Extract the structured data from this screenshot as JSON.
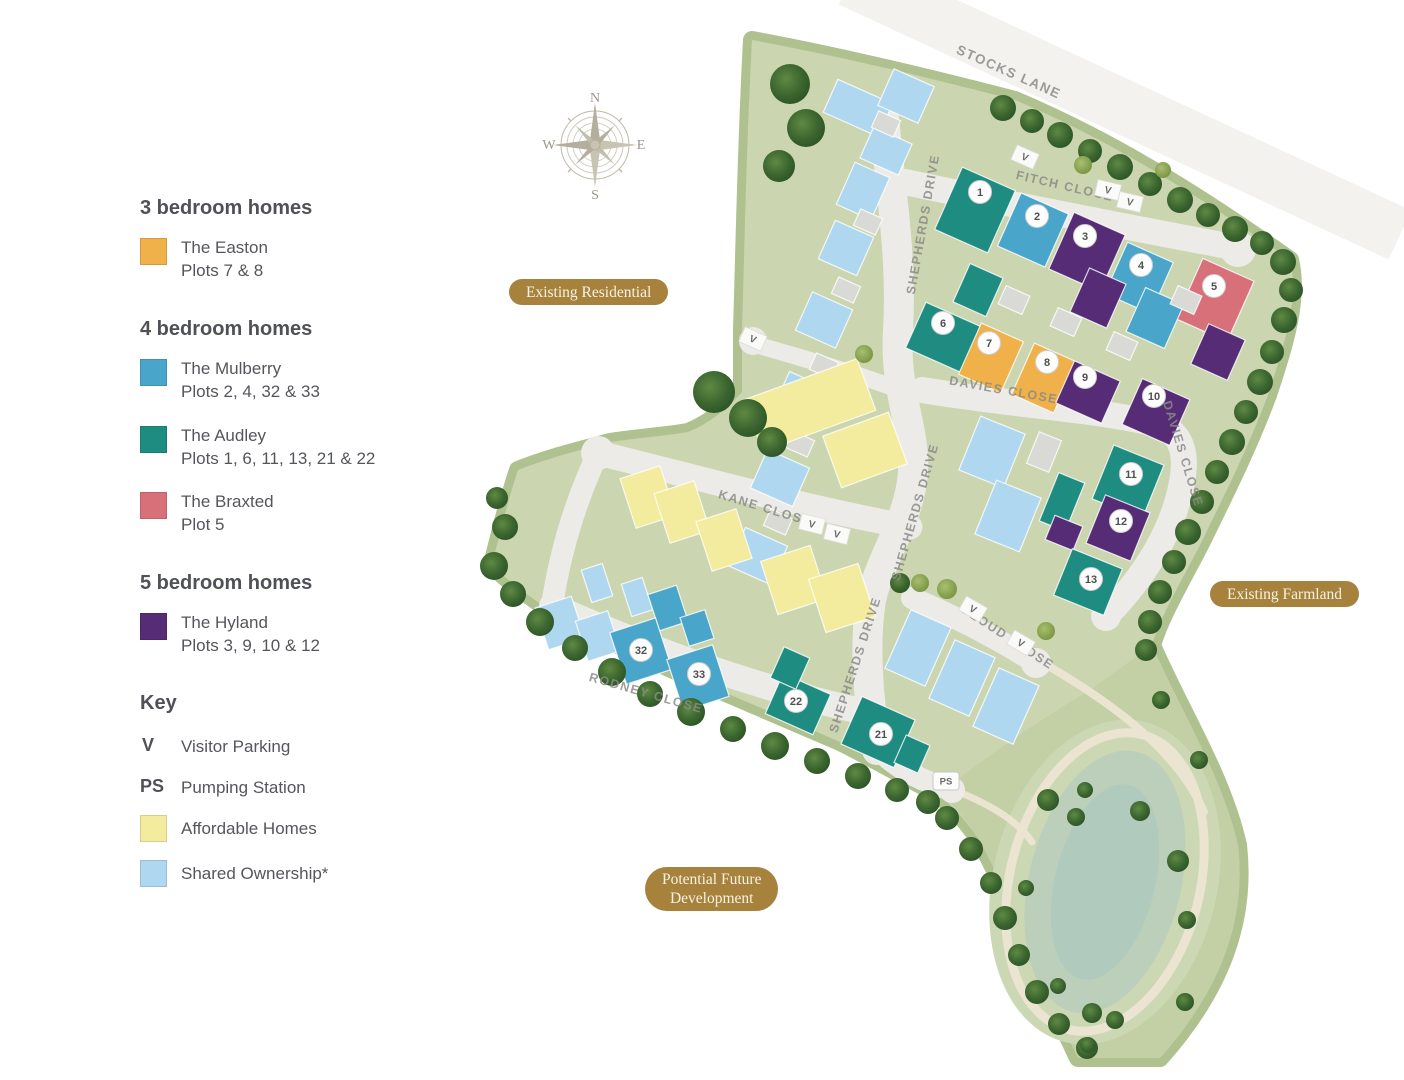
{
  "legend": {
    "sections": [
      {
        "heading": "3 bedroom homes",
        "items": [
          {
            "type": "easton",
            "name": "The Easton",
            "plots": "Plots 7 & 8"
          }
        ]
      },
      {
        "heading": "4 bedroom homes",
        "items": [
          {
            "type": "mulberry",
            "name": "The Mulberry",
            "plots": "Plots 2, 4, 32 & 33"
          },
          {
            "type": "audley",
            "name": "The Audley",
            "plots": "Plots 1, 6, 11, 13, 21 & 22"
          },
          {
            "type": "braxted",
            "name": "The Braxted",
            "plots": "Plot 5"
          }
        ]
      },
      {
        "heading": "5 bedroom homes",
        "items": [
          {
            "type": "hyland",
            "name": "The Hyland",
            "plots": "Plots 3, 9, 10 & 12"
          }
        ]
      }
    ],
    "key": {
      "heading": "Key",
      "visitor_symbol": "V",
      "visitor_label": "Visitor Parking",
      "pump_symbol": "PS",
      "pump_label": "Pumping Station",
      "affordable_label": "Affordable Homes",
      "shared_label": "Shared Ownership*"
    }
  },
  "compass": {
    "n": "N",
    "e": "E",
    "s": "S",
    "w": "W"
  },
  "area_labels": {
    "existing_residential": "Existing Residential",
    "existing_farmland": "Existing Farmland",
    "potential_future_1": "Potential Future",
    "potential_future_2": "Development"
  },
  "colors": {
    "easton": "#F0B04A",
    "mulberry": "#49A5C9",
    "audley": "#1F8C82",
    "braxted": "#D8707A",
    "hyland": "#562C77",
    "affordable": "#F3EC9F",
    "shared": "#AFD8F0",
    "garage": "#D9D9D5",
    "site_green": "#CBD5AF",
    "site_edge": "#AEC18F",
    "field_green": "#C3CFA5",
    "mound_green": "#CCD8B4",
    "pond_mid": "#BCCFBA",
    "pond_core": "#B0CABD",
    "road": "#ECEBE8",
    "lane": "#E3E2DE",
    "path_cream": "#EAE4D0",
    "pill_gold": "#A6823C",
    "tree_dark": "#2E5829",
    "tree_light": "#74923F"
  },
  "map": {
    "site_outline": "M752,40 C840,56 930,78 1015,100 C1110,140 1200,196 1290,260 C1300,300 1282,352 1268,395 C1248,448 1226,492 1205,535 C1188,570 1162,612 1152,645 C1180,710 1222,775 1238,845 C1246,915 1225,985 1160,1058 L1078,1058 C1060,1020 1044,986 1032,950 C1014,910 996,870 978,838 C962,816 948,800 930,790 C900,774 870,757 840,742 C794,722 747,702 700,682 C653,661 606,640 560,618 C536,600 510,584 492,565 C500,532 508,500 518,470 C548,458 580,450 610,442 C636,438 664,436 688,432 C708,424 726,410 742,392 L742,330 C744,270 746,150 752,40 Z",
    "field": "M1152,645 C1180,710 1222,775 1238,845 C1246,915 1225,985 1160,1058 L1078,1058 C1060,1020 1044,986 1032,950 C1014,910 996,870 978,838 C966,820 954,804 940,794 C980,760 1040,720 1090,690 C1112,674 1135,658 1152,645 Z",
    "stocks_lane_band": {
      "d": "M850,-20 L1400,235",
      "w": 54
    },
    "roads": [
      {
        "d": "M884,118 C892,200 902,260 898,330 C894,392 916,430 913,472 C910,520 880,558 871,600 C864,644 868,700 877,750",
        "w": 30
      },
      {
        "d": "M877,748 C898,770 924,782 952,790",
        "w": 22
      },
      {
        "d": "M905,182 C990,200 1100,222 1238,248",
        "w": 26
      },
      {
        "d": "M922,390 C1020,406 1102,410 1156,424 C1192,434 1186,472 1177,503 C1164,548 1132,590 1106,616",
        "w": 26
      },
      {
        "d": "M598,453 C700,478 806,508 910,527",
        "w": 25
      },
      {
        "d": "M598,453 C576,500 560,552 552,606",
        "w": 22
      },
      {
        "d": "M552,606 C656,652 762,690 874,714",
        "w": 26
      },
      {
        "d": "M912,598 C958,618 1000,640 1036,663",
        "w": 22
      },
      {
        "d": "M757,345 C810,360 860,375 900,390",
        "w": 17
      }
    ],
    "culdesacs": [
      [
        1238,
        249,
        18
      ],
      [
        598,
        453,
        17
      ],
      [
        1036,
        663,
        15
      ],
      [
        1106,
        616,
        15
      ],
      [
        952,
        790,
        13
      ],
      [
        753,
        341,
        14
      ]
    ],
    "cream_paths": [
      {
        "d": "M1038,660 C1108,700 1176,748 1204,812",
        "w": 8
      },
      {
        "d": "M954,790 C994,806 1018,822 1032,842",
        "w": 7
      }
    ],
    "pond": {
      "cx": 1105,
      "cy": 882,
      "rot": 14,
      "mound_rx": 112,
      "mound_ry": 165,
      "loop_rx": 95,
      "loop_ry": 152,
      "mid_rx": 76,
      "mid_ry": 134,
      "core_rx": 50,
      "core_ry": 100
    },
    "houses": [
      [
        "shared",
        858,
        108,
        60,
        36,
        24
      ],
      [
        "shared",
        906,
        96,
        44,
        40,
        24
      ],
      [
        "shared",
        886,
        151,
        42,
        34,
        24
      ],
      [
        "shared",
        863,
        191,
        38,
        46,
        24
      ],
      [
        "shared",
        846,
        248,
        42,
        42,
        24
      ],
      [
        "shared",
        824,
        320,
        44,
        42,
        24
      ],
      [
        "shared",
        802,
        400,
        46,
        42,
        24
      ],
      [
        "shared",
        780,
        478,
        46,
        42,
        24
      ],
      [
        "shared",
        758,
        556,
        46,
        42,
        24
      ],
      [
        "garage",
        886,
        124,
        24,
        18,
        24
      ],
      [
        "garage",
        868,
        222,
        24,
        18,
        24
      ],
      [
        "garage",
        846,
        290,
        24,
        18,
        24
      ],
      [
        "garage",
        824,
        366,
        24,
        18,
        24
      ],
      [
        "garage",
        800,
        444,
        24,
        18,
        24
      ],
      [
        "garage",
        778,
        522,
        24,
        18,
        24
      ],
      [
        "audley",
        975,
        210,
        58,
        68,
        24
      ],
      [
        "mulberry",
        1033,
        230,
        52,
        58,
        24
      ],
      [
        "hyland",
        1087,
        252,
        56,
        62,
        24
      ],
      [
        "mulberry",
        1139,
        278,
        50,
        56,
        24
      ],
      [
        "braxted",
        1215,
        300,
        56,
        66,
        24
      ],
      [
        "hyland",
        1098,
        298,
        40,
        48,
        24
      ],
      [
        "mulberry",
        1155,
        318,
        42,
        48,
        24
      ],
      [
        "hyland",
        1218,
        352,
        40,
        44,
        24
      ],
      [
        "audley",
        978,
        290,
        36,
        42,
        24
      ],
      [
        "audley",
        945,
        338,
        64,
        50,
        24
      ],
      [
        "easton",
        991,
        358,
        46,
        56,
        24
      ],
      [
        "easton",
        1044,
        378,
        46,
        56,
        24
      ],
      [
        "hyland",
        1088,
        392,
        50,
        46,
        24
      ],
      [
        "hyland",
        1156,
        412,
        52,
        50,
        24
      ],
      [
        "garage",
        1014,
        300,
        26,
        20,
        24
      ],
      [
        "garage",
        1066,
        322,
        26,
        20,
        24
      ],
      [
        "garage",
        1122,
        346,
        26,
        20,
        24
      ],
      [
        "garage",
        1186,
        300,
        26,
        20,
        24
      ],
      [
        "shared",
        992,
        452,
        48,
        58,
        22
      ],
      [
        "shared",
        1008,
        516,
        48,
        58,
        22
      ],
      [
        "audley",
        1128,
        482,
        54,
        58,
        22
      ],
      [
        "audley",
        1062,
        502,
        28,
        52,
        22
      ],
      [
        "hyland",
        1118,
        528,
        48,
        52,
        22
      ],
      [
        "hyland",
        1064,
        533,
        30,
        26,
        22
      ],
      [
        "audley",
        1088,
        582,
        54,
        50,
        22
      ],
      [
        "garage",
        1044,
        452,
        24,
        34,
        22
      ],
      [
        "shared",
        918,
        648,
        44,
        64,
        24
      ],
      [
        "shared",
        962,
        678,
        44,
        64,
        24
      ],
      [
        "shared",
        1006,
        706,
        44,
        64,
        24
      ],
      [
        "audley",
        878,
        732,
        58,
        52,
        24
      ],
      [
        "audley",
        912,
        754,
        26,
        30,
        24
      ],
      [
        "audley",
        798,
        704,
        52,
        44,
        24
      ],
      [
        "audley",
        790,
        668,
        28,
        34,
        24
      ],
      [
        "affordable",
        810,
        405,
        120,
        55,
        -20
      ],
      [
        "affordable",
        865,
        450,
        70,
        55,
        -20
      ],
      [
        "affordable",
        648,
        497,
        42,
        52,
        -18
      ],
      [
        "affordable",
        682,
        512,
        42,
        52,
        -18
      ],
      [
        "affordable",
        724,
        540,
        42,
        52,
        -18
      ],
      [
        "affordable",
        794,
        580,
        52,
        56,
        -18
      ],
      [
        "affordable",
        842,
        598,
        52,
        56,
        -18
      ],
      [
        "shared",
        560,
        623,
        38,
        44,
        -18
      ],
      [
        "shared",
        598,
        636,
        34,
        42,
        -18
      ],
      [
        "shared",
        597,
        583,
        22,
        34,
        -18
      ],
      [
        "shared",
        637,
        597,
        22,
        34,
        -18
      ],
      [
        "mulberry",
        668,
        608,
        30,
        38,
        -18
      ],
      [
        "mulberry",
        641,
        651,
        48,
        54,
        -18
      ],
      [
        "mulberry",
        697,
        628,
        26,
        30,
        -18
      ],
      [
        "mulberry",
        698,
        678,
        48,
        54,
        -18
      ]
    ],
    "trees": [
      [
        1003,
        108,
        13,
        "d"
      ],
      [
        1032,
        121,
        12,
        "d"
      ],
      [
        1060,
        135,
        13,
        "d"
      ],
      [
        1090,
        151,
        12,
        "d"
      ],
      [
        1120,
        167,
        13,
        "d"
      ],
      [
        1150,
        184,
        12,
        "d"
      ],
      [
        1180,
        200,
        13,
        "d"
      ],
      [
        1208,
        215,
        12,
        "d"
      ],
      [
        1235,
        229,
        13,
        "d"
      ],
      [
        1262,
        243,
        12,
        "d"
      ],
      [
        1283,
        262,
        13,
        "d"
      ],
      [
        1291,
        290,
        12,
        "d"
      ],
      [
        1284,
        320,
        13,
        "d"
      ],
      [
        1272,
        352,
        12,
        "d"
      ],
      [
        1260,
        382,
        13,
        "d"
      ],
      [
        1246,
        412,
        12,
        "d"
      ],
      [
        1232,
        442,
        13,
        "d"
      ],
      [
        1217,
        472,
        12,
        "d"
      ],
      [
        1202,
        502,
        12,
        "d"
      ],
      [
        1188,
        532,
        13,
        "d"
      ],
      [
        1174,
        562,
        12,
        "d"
      ],
      [
        1160,
        592,
        12,
        "d"
      ],
      [
        1150,
        622,
        12,
        "d"
      ],
      [
        1146,
        650,
        11,
        "d"
      ],
      [
        494,
        566,
        14,
        "d"
      ],
      [
        513,
        594,
        13,
        "d"
      ],
      [
        540,
        622,
        14,
        "d"
      ],
      [
        575,
        648,
        13,
        "d"
      ],
      [
        612,
        672,
        14,
        "d"
      ],
      [
        650,
        694,
        13,
        "d"
      ],
      [
        691,
        712,
        14,
        "d"
      ],
      [
        733,
        729,
        13,
        "d"
      ],
      [
        775,
        746,
        14,
        "d"
      ],
      [
        817,
        761,
        13,
        "d"
      ],
      [
        858,
        776,
        13,
        "d"
      ],
      [
        897,
        790,
        12,
        "d"
      ],
      [
        928,
        802,
        12,
        "d"
      ],
      [
        947,
        818,
        12,
        "d"
      ],
      [
        971,
        849,
        12,
        "d"
      ],
      [
        991,
        883,
        11,
        "d"
      ],
      [
        1005,
        918,
        12,
        "d"
      ],
      [
        1019,
        955,
        11,
        "d"
      ],
      [
        1037,
        992,
        12,
        "d"
      ],
      [
        1059,
        1024,
        11,
        "d"
      ],
      [
        1087,
        1048,
        11,
        "d"
      ],
      [
        790,
        84,
        20,
        "d"
      ],
      [
        806,
        128,
        19,
        "d"
      ],
      [
        779,
        166,
        16,
        "d"
      ],
      [
        714,
        392,
        21,
        "d"
      ],
      [
        748,
        418,
        19,
        "d"
      ],
      [
        772,
        442,
        15,
        "d"
      ],
      [
        505,
        527,
        13,
        "d"
      ],
      [
        497,
        498,
        11,
        "d"
      ],
      [
        864,
        354,
        9,
        "l"
      ],
      [
        900,
        583,
        10,
        "d"
      ],
      [
        947,
        589,
        10,
        "l"
      ],
      [
        1046,
        631,
        9,
        "l"
      ],
      [
        920,
        583,
        9,
        "l"
      ],
      [
        1083,
        165,
        9,
        "l"
      ],
      [
        1163,
        170,
        8,
        "l"
      ],
      [
        1048,
        800,
        11,
        "d"
      ],
      [
        1076,
        817,
        9,
        "d"
      ],
      [
        1140,
        811,
        10,
        "d"
      ],
      [
        1178,
        861,
        11,
        "d"
      ],
      [
        1199,
        760,
        9,
        "d"
      ],
      [
        1161,
        700,
        9,
        "d"
      ],
      [
        1026,
        888,
        8,
        "d"
      ],
      [
        1092,
        1013,
        10,
        "d"
      ],
      [
        1115,
        1020,
        9,
        "d"
      ],
      [
        1058,
        986,
        8,
        "d"
      ],
      [
        1085,
        790,
        8,
        "d"
      ],
      [
        1187,
        920,
        9,
        "d"
      ],
      [
        1185,
        1002,
        9,
        "d"
      ],
      [
        1088,
        1045,
        8,
        "d"
      ]
    ],
    "road_labels": [
      {
        "text": "STOCKS LANE",
        "x": 1007,
        "y": 76,
        "rot": 24,
        "size": 13.5
      },
      {
        "text": "FITCH CLOSE",
        "x": 1064,
        "y": 190,
        "rot": 13,
        "size": 12.5
      },
      {
        "text": "SHEPHERDS DRIVE",
        "x": 927,
        "y": 225,
        "rot": -80,
        "size": 12.5
      },
      {
        "text": "DAVIES CLOSE",
        "x": 1003,
        "y": 394,
        "rot": 10,
        "size": 12.5
      },
      {
        "text": "DAVIES CLOSE",
        "x": 1179,
        "y": 455,
        "rot": 73,
        "size": 12.5
      },
      {
        "text": "SHEPHERDS DRIVE",
        "x": 919,
        "y": 513,
        "rot": -74,
        "size": 12.5
      },
      {
        "text": "KANE CLOSE",
        "x": 764,
        "y": 512,
        "rot": 17,
        "size": 12.5
      },
      {
        "text": "SHEPHERDS DRIVE",
        "x": 859,
        "y": 666,
        "rot": -72,
        "size": 12.5
      },
      {
        "text": "RODNEY CLOSE",
        "x": 645,
        "y": 697,
        "rot": 16,
        "size": 12.5
      },
      {
        "text": "FLOUD CLOSE",
        "x": 1006,
        "y": 641,
        "rot": 33,
        "size": 12.5
      }
    ],
    "plot_markers": [
      {
        "n": "1",
        "x": 980,
        "y": 192
      },
      {
        "n": "2",
        "x": 1037,
        "y": 216
      },
      {
        "n": "3",
        "x": 1085,
        "y": 236
      },
      {
        "n": "4",
        "x": 1141,
        "y": 265
      },
      {
        "n": "5",
        "x": 1214,
        "y": 286
      },
      {
        "n": "6",
        "x": 943,
        "y": 323
      },
      {
        "n": "7",
        "x": 989,
        "y": 343
      },
      {
        "n": "8",
        "x": 1047,
        "y": 362
      },
      {
        "n": "9",
        "x": 1085,
        "y": 377
      },
      {
        "n": "10",
        "x": 1154,
        "y": 396
      },
      {
        "n": "11",
        "x": 1131,
        "y": 474
      },
      {
        "n": "12",
        "x": 1121,
        "y": 521
      },
      {
        "n": "13",
        "x": 1091,
        "y": 579
      },
      {
        "n": "21",
        "x": 881,
        "y": 734
      },
      {
        "n": "22",
        "x": 796,
        "y": 701
      },
      {
        "n": "32",
        "x": 641,
        "y": 650
      },
      {
        "n": "33",
        "x": 699,
        "y": 674
      }
    ],
    "v_markers": [
      {
        "v": "V",
        "x": 1025,
        "y": 157,
        "rot": 24
      },
      {
        "v": "V",
        "x": 1108,
        "y": 190,
        "rot": 13
      },
      {
        "v": "V",
        "x": 1130,
        "y": 202,
        "rot": 13
      },
      {
        "v": "V",
        "x": 753,
        "y": 339,
        "rot": 24
      },
      {
        "v": "V",
        "x": 812,
        "y": 524,
        "rot": 14
      },
      {
        "v": "V",
        "x": 837,
        "y": 534,
        "rot": 14
      },
      {
        "v": "V",
        "x": 973,
        "y": 609,
        "rot": 30
      },
      {
        "v": "V",
        "x": 1021,
        "y": 643,
        "rot": 30
      }
    ],
    "ps_marker": {
      "label": "PS",
      "x": 946,
      "y": 781
    }
  }
}
